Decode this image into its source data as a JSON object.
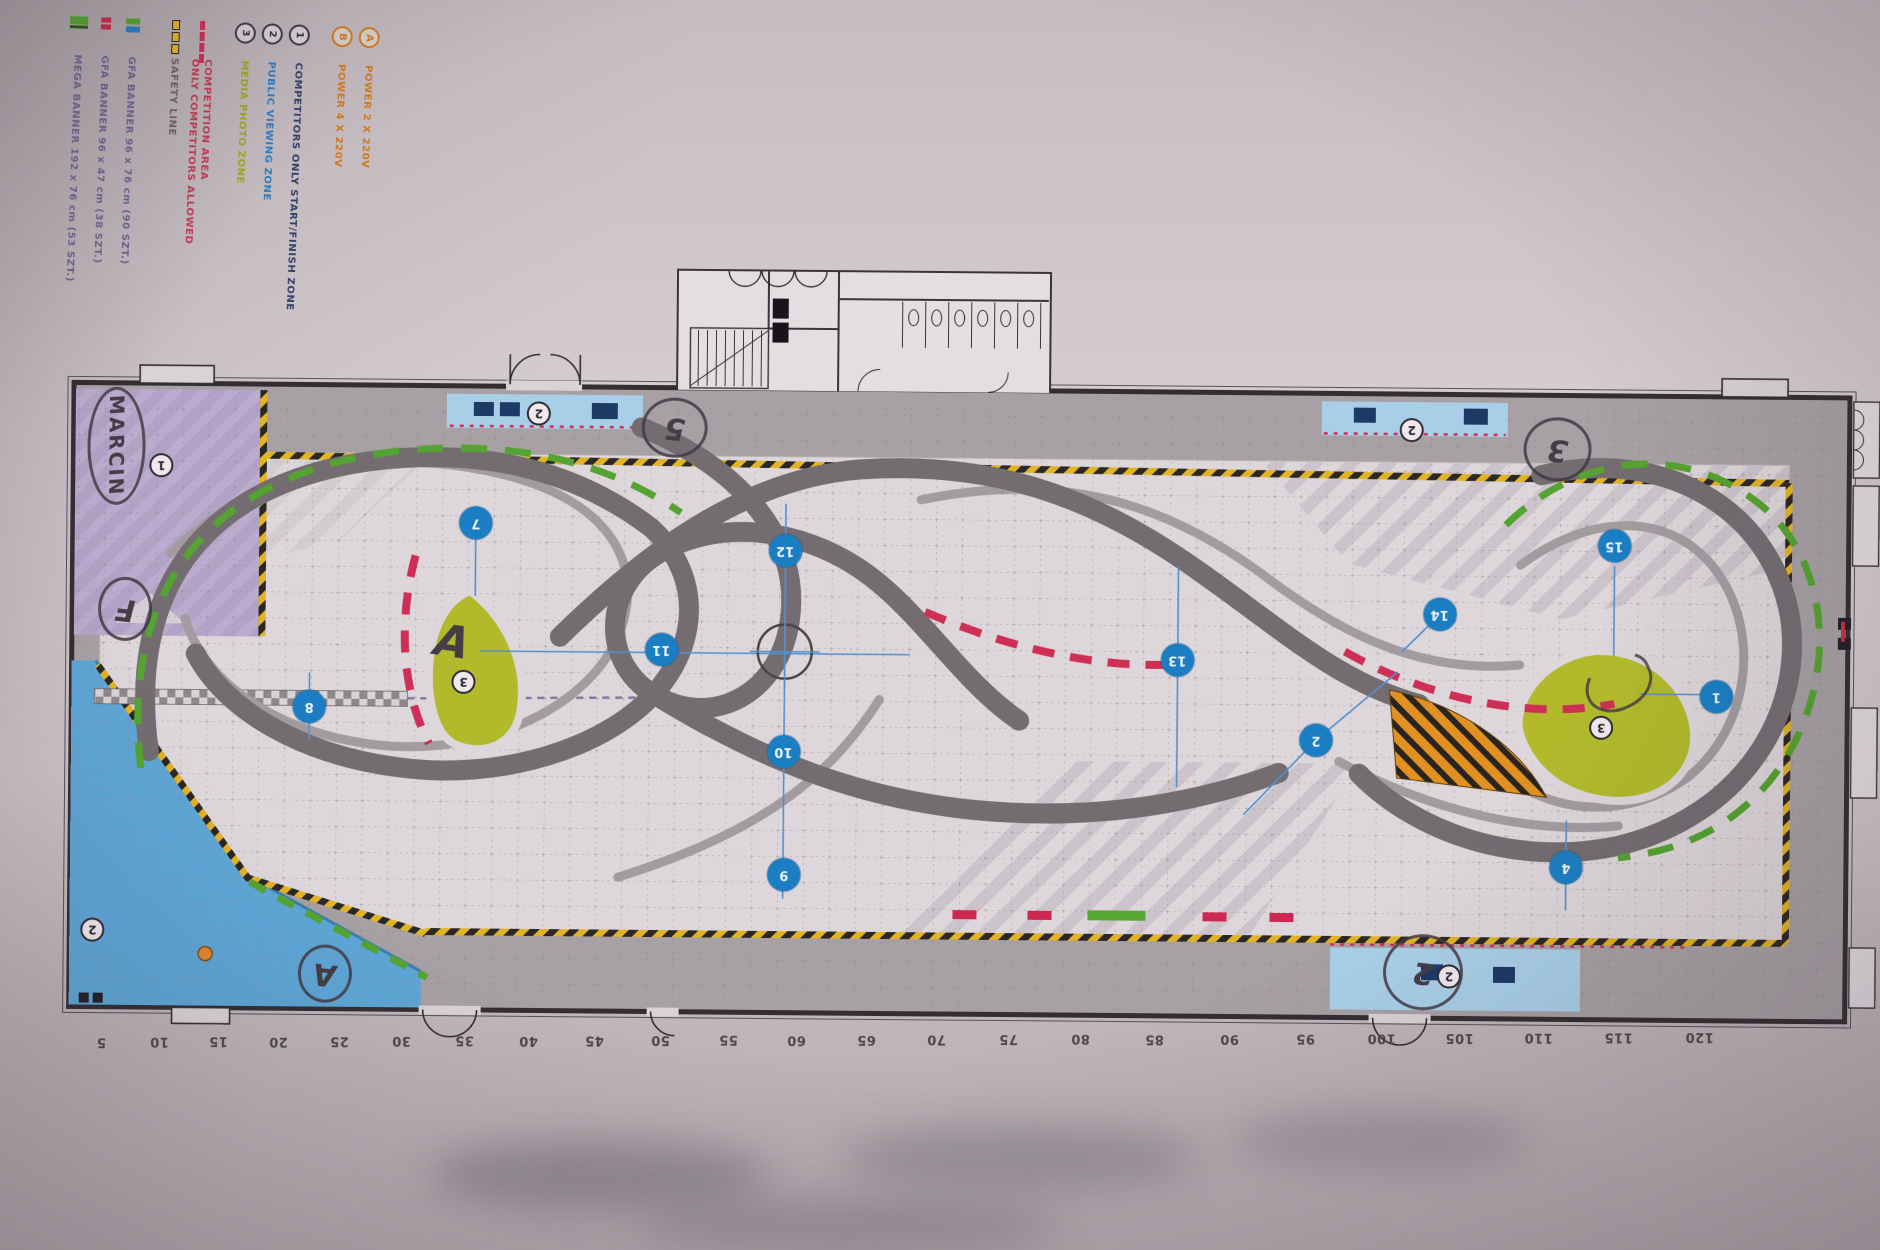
{
  "legend": {
    "power": [
      {
        "badge": "A",
        "label": "POWER 2 X 220V",
        "color": "#cf7a1e"
      },
      {
        "badge": "B",
        "label": "POWER 4 X 220V",
        "color": "#cf7a1e"
      }
    ],
    "zones": [
      {
        "badge": "1",
        "label": "COMPETITORS ONLY START/FINISH ZONE",
        "color": "#33406b"
      },
      {
        "badge": "2",
        "label": "PUBLIC VIEWING ZONE",
        "color": "#2f7cc0"
      },
      {
        "badge": "3",
        "label": "MEDIA PHOTO ZONE",
        "color": "#a2a51f"
      }
    ],
    "lines": [
      {
        "symbol": "red-dash",
        "label": "COMPETITION AREA",
        "label2": "ONLY COMPETITORS ALLOWED",
        "color": "#c23b53"
      },
      {
        "symbol": "safety-dash",
        "label": "SAFETY LINE",
        "color": "#6b6468"
      }
    ],
    "banners": [
      {
        "symbol": "gfa-banner-large",
        "label": "GFA BANNER 96 x 76 cm (90 SZT.)",
        "color": "#6e6390"
      },
      {
        "symbol": "gfa-banner-small",
        "label": "GFA BANNER 96 x 47 cm (38 SZT.)",
        "color": "#6e6390"
      },
      {
        "symbol": "mega-banner",
        "label": "MEGA BANNER 192 x 76 cm (53 SZT.)",
        "color": "#6e6390"
      }
    ]
  },
  "ruler": {
    "items": [
      {
        "v": "5",
        "x": 105,
        "y": 1049
      },
      {
        "v": "10",
        "x": 163,
        "y": 1048
      },
      {
        "v": "15",
        "x": 222,
        "y": 1047
      },
      {
        "v": "20",
        "x": 282,
        "y": 1047
      },
      {
        "v": "25",
        "x": 343,
        "y": 1046
      },
      {
        "v": "30",
        "x": 405,
        "y": 1045
      },
      {
        "v": "35",
        "x": 468,
        "y": 1044
      },
      {
        "v": "40",
        "x": 532,
        "y": 1044
      },
      {
        "v": "45",
        "x": 598,
        "y": 1043
      },
      {
        "v": "50",
        "x": 664,
        "y": 1042
      },
      {
        "v": "55",
        "x": 732,
        "y": 1041
      },
      {
        "v": "60",
        "x": 800,
        "y": 1041
      },
      {
        "v": "65",
        "x": 870,
        "y": 1040
      },
      {
        "v": "70",
        "x": 940,
        "y": 1039
      },
      {
        "v": "75",
        "x": 1012,
        "y": 1038
      },
      {
        "v": "80",
        "x": 1084,
        "y": 1037
      },
      {
        "v": "85",
        "x": 1158,
        "y": 1037
      },
      {
        "v": "90",
        "x": 1233,
        "y": 1036
      },
      {
        "v": "95",
        "x": 1309,
        "y": 1035
      },
      {
        "v": "100",
        "x": 1385,
        "y": 1034
      },
      {
        "v": "105",
        "x": 1463,
        "y": 1033
      },
      {
        "v": "110",
        "x": 1542,
        "y": 1032
      },
      {
        "v": "115",
        "x": 1622,
        "y": 1031
      },
      {
        "v": "120",
        "x": 1703,
        "y": 1030
      }
    ]
  },
  "markers": [
    {
      "n": "7",
      "x": 475,
      "y": 527
    },
    {
      "n": "8",
      "x": 310,
      "y": 712
    },
    {
      "n": "11",
      "x": 662,
      "y": 652
    },
    {
      "n": "12",
      "x": 785,
      "y": 552
    },
    {
      "n": "10",
      "x": 785,
      "y": 753
    },
    {
      "n": "9",
      "x": 786,
      "y": 876
    },
    {
      "n": "13",
      "x": 1178,
      "y": 658
    },
    {
      "n": "2",
      "x": 1317,
      "y": 737
    },
    {
      "n": "14",
      "x": 1440,
      "y": 610
    },
    {
      "n": "15",
      "x": 1614,
      "y": 540
    },
    {
      "n": "1",
      "x": 1717,
      "y": 690
    },
    {
      "n": "4",
      "x": 1568,
      "y": 862
    }
  ],
  "zone_badges": [
    {
      "n": "1",
      "x": 160,
      "y": 472
    },
    {
      "n": "2",
      "x": 537,
      "y": 417
    },
    {
      "n": "2",
      "x": 1410,
      "y": 426
    },
    {
      "n": "2",
      "x": 95,
      "y": 937
    },
    {
      "n": "2",
      "x": 1452,
      "y": 972
    },
    {
      "n": "3",
      "x": 464,
      "y": 686
    },
    {
      "n": "3",
      "x": 1602,
      "y": 722
    }
  ],
  "annotations": [
    {
      "text": "MARCIN",
      "x": 86,
      "y": 394,
      "w": 52,
      "h": 112,
      "kind": "ellipse-vert"
    },
    {
      "text": "F",
      "x": 98,
      "y": 584,
      "w": 48,
      "h": 58,
      "kind": "ellipse"
    },
    {
      "text": "A",
      "x": 426,
      "y": 618,
      "w": 52,
      "h": 56,
      "kind": "plain"
    },
    {
      "text": "5",
      "x": 640,
      "y": 400,
      "w": 60,
      "h": 54,
      "kind": "ellipse"
    },
    {
      "text": "3",
      "x": 1522,
      "y": 412,
      "w": 62,
      "h": 58,
      "kind": "ellipse"
    },
    {
      "text": "2",
      "x": 1386,
      "y": 930,
      "w": 74,
      "h": 70,
      "kind": "ellipse"
    },
    {
      "text": "A",
      "x": 301,
      "y": 950,
      "w": 48,
      "h": 52,
      "kind": "ellipse"
    },
    {
      "text": "",
      "x": 1584,
      "y": 650,
      "w": 64,
      "h": 48,
      "kind": "squiggle"
    }
  ],
  "colors": {
    "track_dark": "#736d72",
    "track_light": "#a29ba0",
    "hazard_yellow": "#e2b322",
    "marker_blue": "#1b7ec2",
    "island_olive": "#b2ba2c",
    "zone_purple": "#b3a2c5",
    "zone_blue": "#5ea6d6",
    "strip_blue": "#a9cfe8",
    "red_dash": "#cf2f55",
    "green_dash": "#55a330",
    "orange_hatch": "#e09122"
  }
}
